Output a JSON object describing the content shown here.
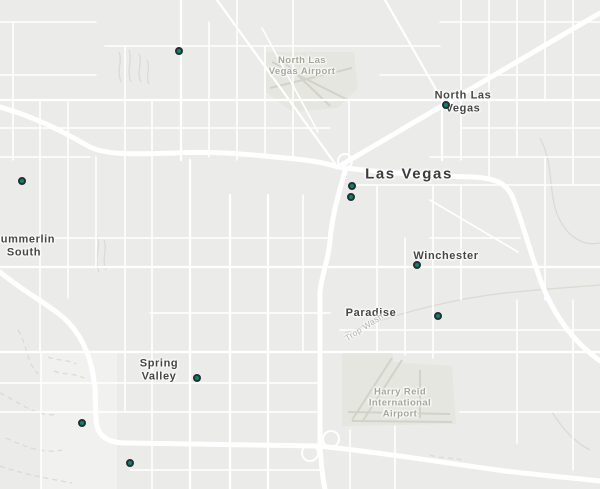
{
  "map": {
    "colors": {
      "background": "#ebebe9",
      "road": "#ffffff",
      "airport_fill": "#e6e6e0",
      "runway_stroke": "#d2d2c9",
      "wash_stroke": "#dbdbd4",
      "marker_fill": "#0e8170",
      "marker_border": "#262f30",
      "city_label": "#3c3c3c",
      "suburb_label": "#464646",
      "airport_label": "#a6a69a",
      "wash_label": "#b2b2aa"
    },
    "labels": [
      {
        "id": "north-las-vegas-airport",
        "type": "airport",
        "x": 302,
        "y": 66,
        "rotation": 0,
        "lines": [
          "North Las",
          "Vegas Airport"
        ]
      },
      {
        "id": "north-las-vegas",
        "type": "suburb",
        "x": 463,
        "y": 102,
        "rotation": 0,
        "lines": [
          "North Las",
          "Vegas"
        ]
      },
      {
        "id": "las-vegas",
        "type": "city",
        "x": 409,
        "y": 174,
        "rotation": 0,
        "lines": [
          "Las Vegas"
        ]
      },
      {
        "id": "summerlin-south",
        "type": "suburb",
        "x": 24,
        "y": 246,
        "rotation": 0,
        "lines": [
          "Summerlin",
          "South"
        ]
      },
      {
        "id": "winchester",
        "type": "suburb",
        "x": 446,
        "y": 256,
        "rotation": 0,
        "lines": [
          "Winchester"
        ]
      },
      {
        "id": "paradise",
        "type": "suburb",
        "x": 371,
        "y": 313,
        "rotation": 0,
        "lines": [
          "Paradise"
        ]
      },
      {
        "id": "trop-wash",
        "type": "wash",
        "x": 364,
        "y": 327,
        "rotation": -33,
        "lines": [
          "Trop Wash"
        ]
      },
      {
        "id": "spring-valley",
        "type": "suburb",
        "x": 159,
        "y": 370,
        "rotation": 0,
        "lines": [
          "Spring",
          "Valley"
        ]
      },
      {
        "id": "harry-reid-airport",
        "type": "airport",
        "x": 400,
        "y": 403,
        "rotation": 0,
        "lines": [
          "Harry Reid",
          "International",
          "Airport"
        ]
      }
    ],
    "markers": [
      {
        "x": 179,
        "y": 51
      },
      {
        "x": 446,
        "y": 105
      },
      {
        "x": 22,
        "y": 181
      },
      {
        "x": 352,
        "y": 186
      },
      {
        "x": 351,
        "y": 197
      },
      {
        "x": 417,
        "y": 265
      },
      {
        "x": 438,
        "y": 316
      },
      {
        "x": 197,
        "y": 378
      },
      {
        "x": 82,
        "y": 423
      },
      {
        "x": 130,
        "y": 463
      }
    ]
  }
}
